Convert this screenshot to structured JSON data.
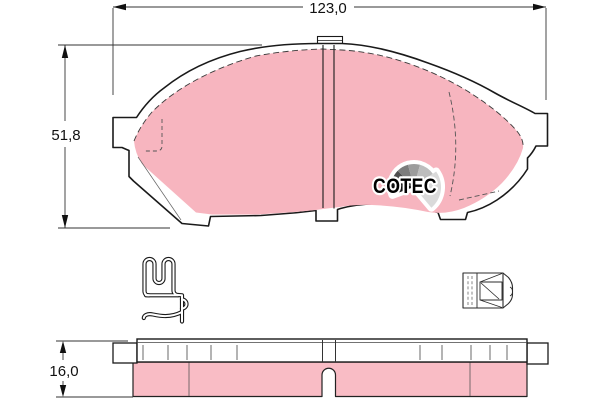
{
  "dimensions": {
    "width_label": "123,0",
    "height_label": "51,8",
    "thickness_label": "16,0"
  },
  "logo": {
    "text": "COTEC"
  },
  "colors": {
    "friction_pink": "#F7B5BF",
    "side_pink": "#F9BCC5",
    "outline": "#1a1a1a",
    "fan_segments": [
      "#101010",
      "#4e4e4e",
      "#7c7c7c",
      "#9c9c9c",
      "#bdbdbd",
      "#dadada"
    ]
  }
}
